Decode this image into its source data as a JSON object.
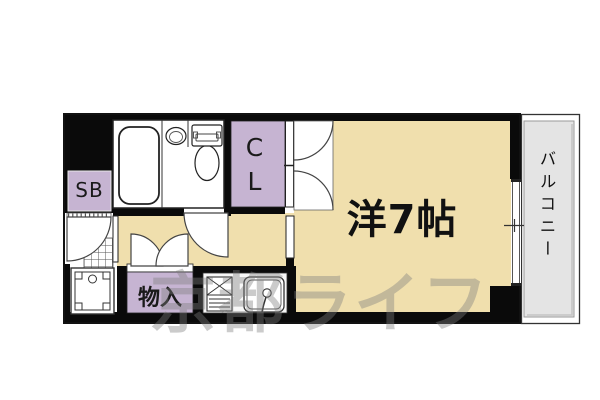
{
  "plan": {
    "room": {
      "label": "洋7帖",
      "type": "western-room",
      "size_tatami": 7
    },
    "closet": {
      "label": "CL"
    },
    "shoe_box": {
      "label": "SB"
    },
    "storage": {
      "label": "物入"
    },
    "balcony": {
      "label": "バルコニー"
    }
  },
  "watermark": {
    "text": "京都ライフ"
  },
  "colors": {
    "wall": "#0A0A0A",
    "room_floor": "#F0DFAD",
    "closet_fill": "#C6B4D2",
    "balcony_fill": "#E4E4E4",
    "fixture_white": "#FFFFFF",
    "watermark_gray": "#7F7F7F"
  },
  "fixtures": [
    "bathtub",
    "wash-basin",
    "toilet",
    "washing-machine-pan",
    "gas-stove",
    "kitchen-sink",
    "sliding-window",
    "entry-door",
    "bathroom-door",
    "closet-doors",
    "storage-doors"
  ]
}
